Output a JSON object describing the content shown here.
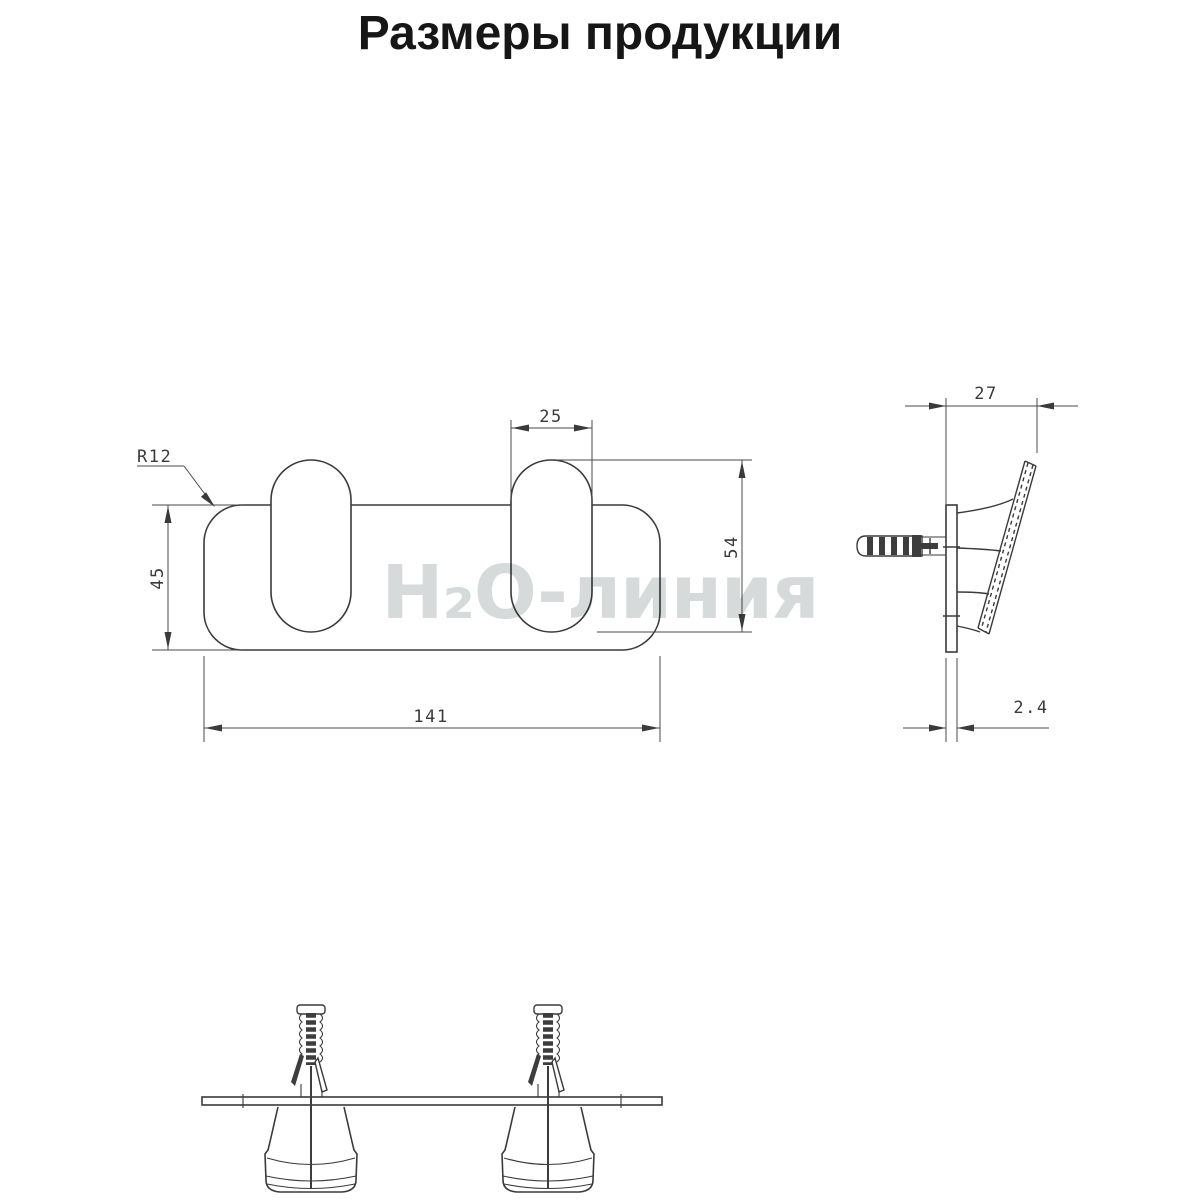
{
  "title": "Размеры продукции",
  "watermark": "H₂O-линия",
  "front_view": {
    "corner_radius": "R12",
    "plate_height": "45",
    "hook_width": "25",
    "hook_height": "54",
    "plate_width": "141"
  },
  "side_view": {
    "projection_depth": "27",
    "plate_thickness": "2.4"
  },
  "colors": {
    "line": "#3a3a3a",
    "dimension_line": "#4a4a4a",
    "watermark": "#d6dada",
    "title": "#161616",
    "background": "#ffffff"
  }
}
